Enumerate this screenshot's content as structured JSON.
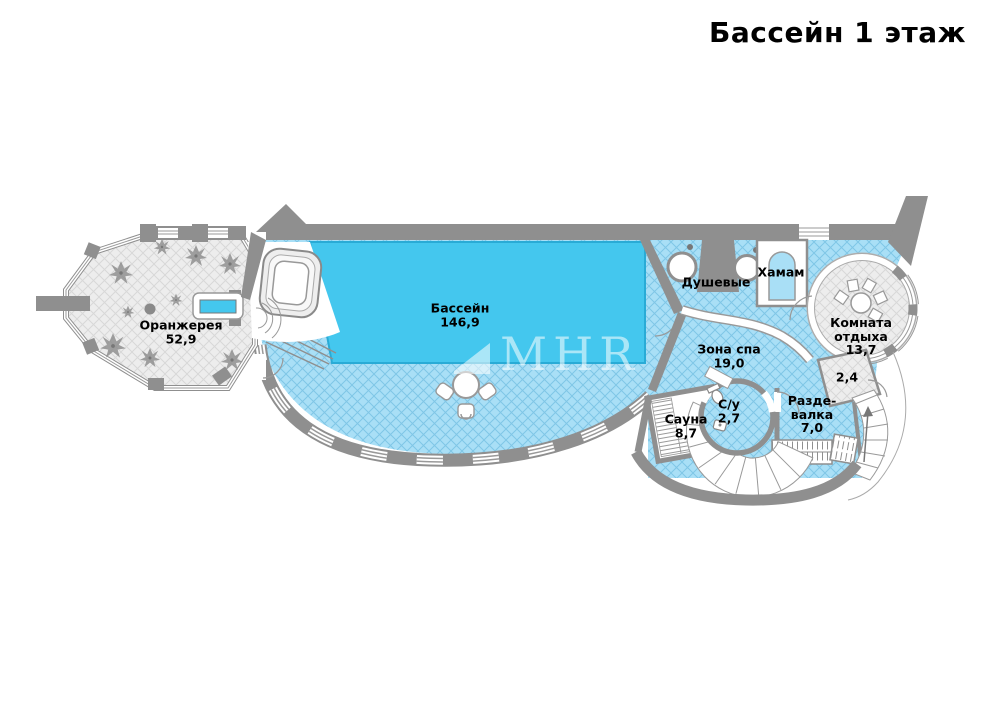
{
  "title": "Бассейн 1 этаж",
  "watermark": {
    "text": "MHR"
  },
  "colors": {
    "pool_water": "#44C7EE",
    "pool_water_edge": "#29ABD6",
    "deck_floor": "#A9DFF6",
    "deck_grid": "#7FC6E6",
    "wall": "#8F8F8F",
    "gray_floor": "#EDEDED",
    "gray_floor_grid": "#D8D8D8",
    "label_text": "#000000"
  },
  "rooms": {
    "orangery": {
      "name": "Оранжерея",
      "area": "52,9"
    },
    "pool": {
      "name": "Бассейн",
      "area": "146,9"
    },
    "showers": {
      "name": "Душевые"
    },
    "hamam": {
      "name": "Хамам"
    },
    "spa": {
      "name": "Зона спа",
      "area": "19,0"
    },
    "lounge": {
      "name": "Комната отдыха",
      "area": "13,7"
    },
    "vestibule": {
      "area": "2,4"
    },
    "sauna": {
      "name": "Сауна",
      "area": "8,7"
    },
    "wc": {
      "name": "С/у",
      "area": "2,7"
    },
    "changing": {
      "name": "Разде-валка",
      "area": "7,0"
    }
  }
}
